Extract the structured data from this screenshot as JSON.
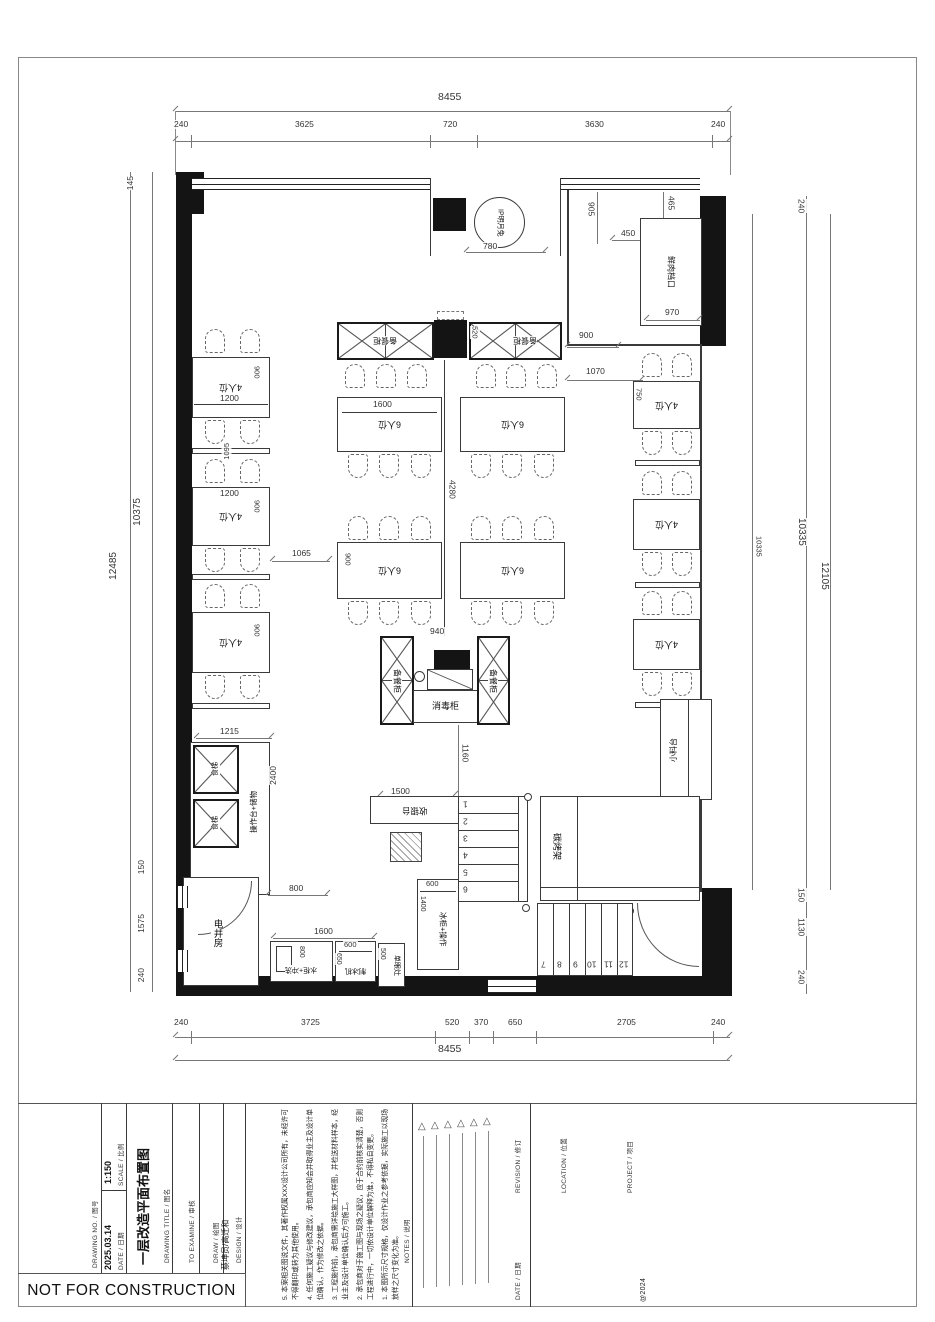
{
  "plan": {
    "labels": {
      "seat4": "4人位",
      "seat6": "6人位",
      "prep": "备餐柜",
      "sterilizer": "消毒柜",
      "ip": "IP明月兔",
      "meat": "鲜肉档口",
      "spice": "小料台",
      "lift": "食梯",
      "worktop": "操作台+储物",
      "shaft": "电井房",
      "sink": "水柜+冲洗",
      "ice": "制冰机",
      "stove": "单眼灶",
      "freezer": "冰柜+操作",
      "cashier": "收银台",
      "grill": "碳烤架"
    },
    "stairs": {
      "upper": [
        "1",
        "2",
        "3",
        "4",
        "5",
        "6"
      ],
      "lower": [
        "7",
        "8",
        "9",
        "10",
        "11",
        "12"
      ]
    },
    "dims": {
      "top_total": "8455",
      "bottom_total": "8455",
      "top": [
        "240",
        "3625",
        "720",
        "3630",
        "240"
      ],
      "bottom": [
        "240",
        "3725",
        "520",
        "370",
        "650",
        "2705",
        "240"
      ],
      "left": {
        "a": "145",
        "b": "10375",
        "c": "12485",
        "d": "150",
        "e": "1575",
        "f": "240"
      },
      "right": {
        "a": "240",
        "b": "10335",
        "c": "12105",
        "d": "150",
        "e": "1130",
        "f": "240",
        "inner": "10335"
      },
      "d1200": "1200",
      "d750": "750",
      "d780": "780",
      "d905": "905",
      "d465": "465",
      "d450": "450",
      "d970": "970",
      "d900": "900",
      "d520": "520",
      "d1070": "1070",
      "d1600": "1600",
      "d4280": "4280",
      "d940": "940",
      "d1095": "1095",
      "d1065": "1065",
      "d1160": "1160",
      "d1500": "1500",
      "d1215": "1215",
      "d2400": "2400",
      "d800": "800",
      "d600": "600",
      "d650": "650",
      "d500": "500",
      "d1400": "1400"
    }
  },
  "title_block": {
    "drawing_no_label": "DRAWING NO. / 图号",
    "scale_label": "SCALE / 比例",
    "scale": "1:150",
    "date_label": "DATE / 日期",
    "date": "2025.03.14",
    "title_label": "DRAWING TITLE / 图名",
    "title": "一层改造平面布置图",
    "examine_label": "TO EXAMINE / 审核",
    "draw_label": "DRAW / 绘图",
    "design_label": "DESIGN / 设计",
    "design": "蔡坤员/高迁和",
    "notes_label": "NOTES / 说明",
    "notes": [
      "1. 本图所示尺寸规格，仅设计作业之参考依据，实际施工以现场放样之尺寸变化为准。",
      "2. 承包商对于施工图与现场之疑议，应于合约前核实清楚，否则工程进行中，一切依设计单位解释为准，不得私自变更。",
      "3. 工程施作前，承包商需详绘施工大样图，并检送材料样本，经业主及设计单位确认后方可施工。",
      "4. 任何施工疑议与修改建议，承包商应知会并取得业主及设计单位确认，作为修改之依据。",
      "5. 本案相关图说文件，其著作权属XXX设计公司所有，未经许可不得翻印或转为其他使用。"
    ],
    "revision_label": "REVISION / 修订",
    "rev_date_label": "DATE / 日期",
    "location_label": "LOCATION / 位置",
    "project_label": "PROJECT / 项目",
    "copyright": "@2024",
    "stamp": "NOT FOR CONSTRUCTION"
  }
}
